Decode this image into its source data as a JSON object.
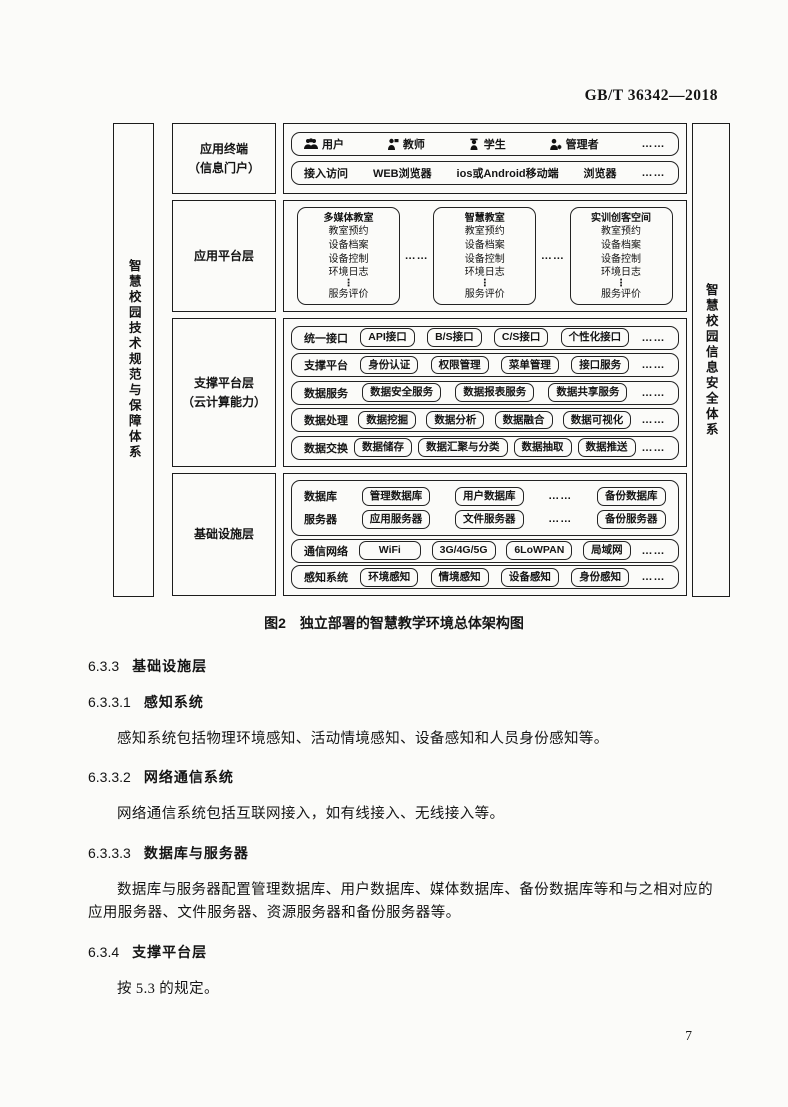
{
  "doc": {
    "number": "GB/T 36342—2018",
    "page_number": "7"
  },
  "figure": {
    "ellipsis_h": "……",
    "ellipsis_v": "⋮",
    "left_bar": "智慧校园技术规范与保障体系",
    "right_bar": "智慧校园信息安全体系",
    "caption_label": "图2",
    "caption_title": "独立部署的智慧教学环境总体架构图",
    "terminal": {
      "label_line1": "应用终端",
      "label_line2": "（信息门户）",
      "roles": [
        {
          "icon": "users-icon",
          "label": "用户"
        },
        {
          "icon": "teacher-icon",
          "label": "教师"
        },
        {
          "icon": "student-icon",
          "label": "学生"
        },
        {
          "icon": "manager-icon",
          "label": "管理者"
        }
      ],
      "access": [
        "接入访问",
        "WEB浏览器",
        "ios或Android移动端",
        "浏览器"
      ]
    },
    "app_platform": {
      "label": "应用平台层",
      "cards": [
        {
          "title": "多媒体教室",
          "items": [
            "教室预约",
            "设备档案",
            "设备控制",
            "环境日志"
          ],
          "footer": "服务评价"
        },
        {
          "title": "智慧教室",
          "items": [
            "教室预约",
            "设备档案",
            "设备控制",
            "环境日志"
          ],
          "footer": "服务评价"
        },
        {
          "title": "实训创客空间",
          "items": [
            "教室预约",
            "设备档案",
            "设备控制",
            "环境日志"
          ],
          "footer": "服务评价"
        }
      ]
    },
    "support_platform": {
      "label_line1": "支撑平台层",
      "label_line2": "（云计算能力）",
      "rows": [
        {
          "label": "统一接口",
          "chips": [
            "API接口",
            "B/S接口",
            "C/S接口",
            "个性化接口"
          ]
        },
        {
          "label": "支撑平台",
          "chips": [
            "身份认证",
            "权限管理",
            "菜单管理",
            "接口服务"
          ]
        },
        {
          "label": "数据服务",
          "chips": [
            "数据安全服务",
            "数据报表服务",
            "数据共享服务"
          ]
        },
        {
          "label": "数据处理",
          "chips": [
            "数据挖掘",
            "数据分析",
            "数据融合",
            "数据可视化"
          ]
        },
        {
          "label": "数据交换",
          "chips": [
            "数据储存",
            "数据汇聚与分类",
            "数据抽取",
            "数据推送"
          ]
        }
      ]
    },
    "infrastructure": {
      "label": "基础设施层",
      "db_line": {
        "label": "数据库",
        "chips": [
          "管理数据库",
          "用户数据库"
        ],
        "last_chip": "备份数据库"
      },
      "server_line": {
        "label": "服务器",
        "chips": [
          "应用服务器",
          "文件服务器"
        ],
        "last_chip": "备份服务器"
      },
      "network": {
        "label": "通信网络",
        "chips": [
          "WiFi",
          "3G/4G/5G",
          "6LoWPAN",
          "局域网"
        ]
      },
      "sensing": {
        "label": "感知系统",
        "chips": [
          "环境感知",
          "情境感知",
          "设备感知",
          "身份感知"
        ]
      }
    }
  },
  "sections": {
    "s633": {
      "number": "6.3.3",
      "title": "基础设施层"
    },
    "s6331": {
      "number": "6.3.3.1",
      "title": "感知系统"
    },
    "p6331": "感知系统包括物理环境感知、活动情境感知、设备感知和人员身份感知等。",
    "s6332": {
      "number": "6.3.3.2",
      "title": "网络通信系统"
    },
    "p6332": "网络通信系统包括互联网接入，如有线接入、无线接入等。",
    "s6333": {
      "number": "6.3.3.3",
      "title": "数据库与服务器"
    },
    "p6333": "数据库与服务器配置管理数据库、用户数据库、媒体数据库、备份数据库等和与之相对应的应用服务器、文件服务器、资源服务器和备份服务器等。",
    "s634": {
      "number": "6.3.4",
      "title": "支撑平台层"
    },
    "p634": "按 5.3 的规定。"
  }
}
